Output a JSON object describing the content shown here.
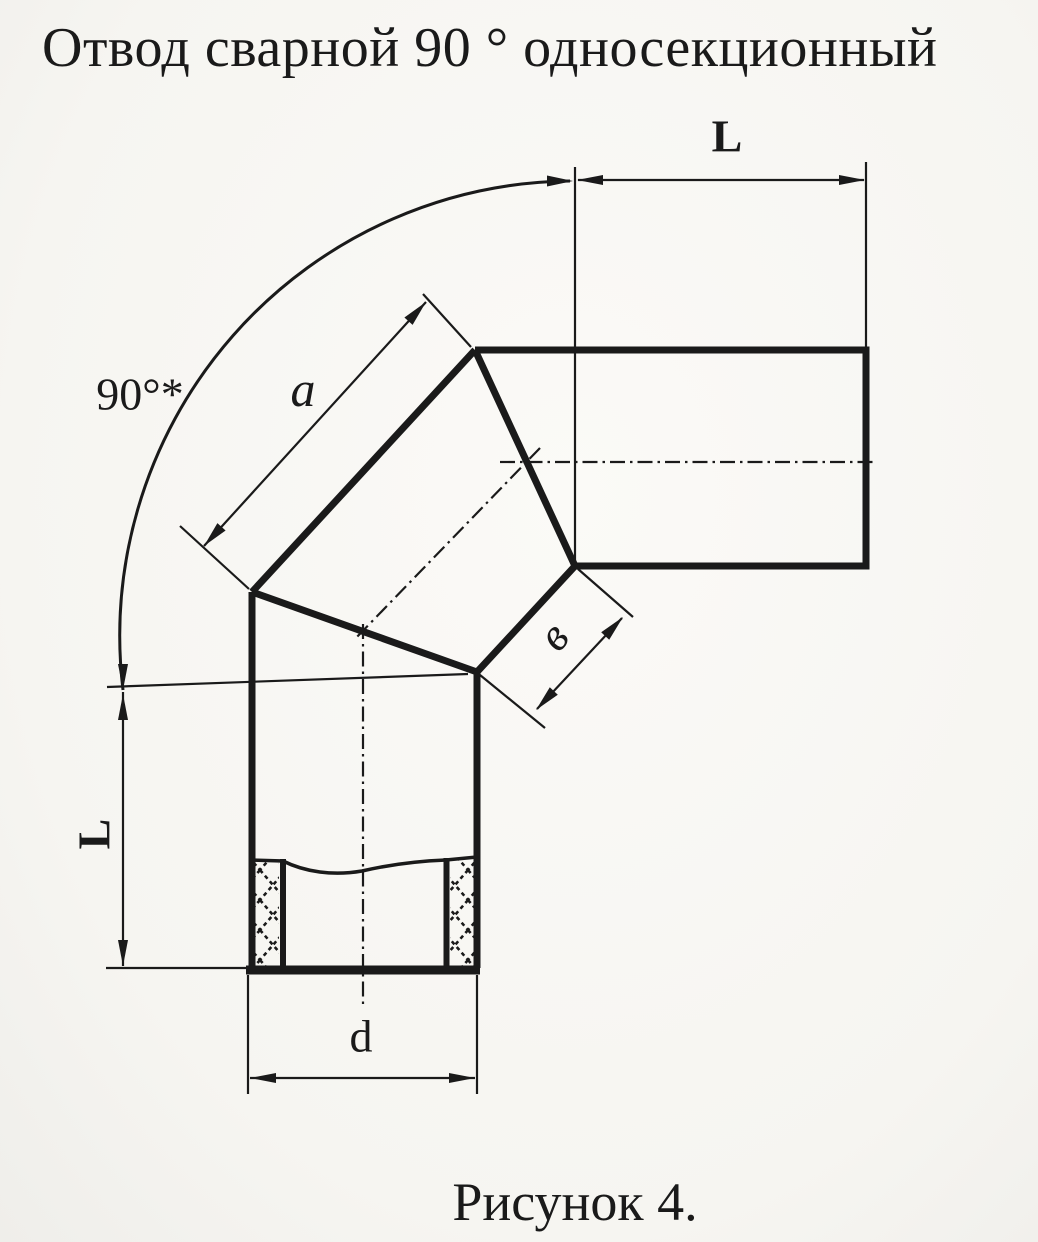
{
  "colors": {
    "paper": "#f6f5f1",
    "ink": "#1a1a1a"
  },
  "header": {
    "title": "Отвод сварной 90 ° односекционный"
  },
  "figure": {
    "caption": "Рисунок 4.",
    "angle_label": "90°*",
    "dim_top_length_label": "L",
    "dim_left_length_label": "L",
    "dim_section_outer_label": "a",
    "dim_section_inner_label": "в",
    "dim_diameter_label": "d"
  }
}
